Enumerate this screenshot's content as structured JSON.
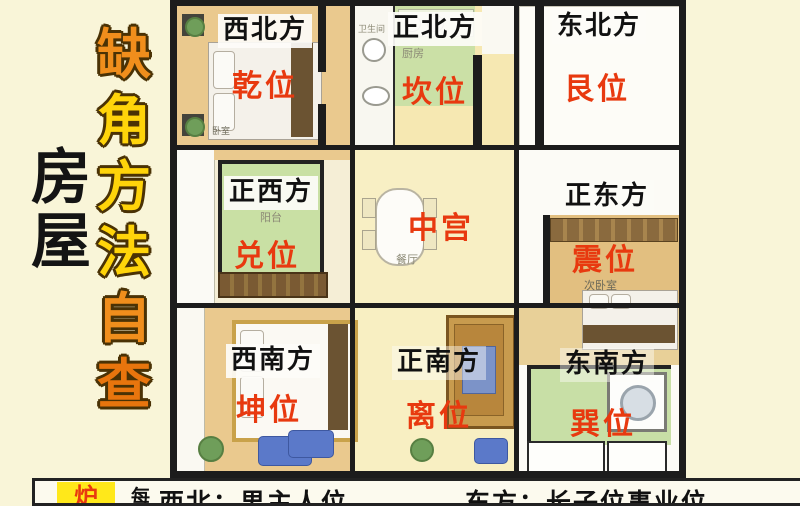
{
  "page": {
    "background": "#F9F5D8"
  },
  "title": {
    "chars": [
      {
        "ch": "缺",
        "tone": "orange"
      },
      {
        "ch": "角",
        "tone": "yellow"
      },
      {
        "ch": "方",
        "tone": "yellow"
      },
      {
        "ch": "法",
        "tone": "yellow"
      },
      {
        "ch": "自",
        "tone": "orange"
      },
      {
        "ch": "查",
        "tone": "deep"
      }
    ],
    "side_chars": [
      "房",
      "屋"
    ],
    "colors": {
      "orange": "#F08E1C",
      "yellow": "#FFD40A",
      "deep_orange": "#E8750D",
      "outline": "#4A3205",
      "side_text": "#141414"
    }
  },
  "floorplan": {
    "cells": [
      {
        "direction": "西北方",
        "position": "乾位",
        "room": "卧室"
      },
      {
        "direction": "正北方",
        "position": "坎位",
        "room": "厨房",
        "room2": "卫生间"
      },
      {
        "direction": "东北方",
        "position": "艮位",
        "room": ""
      },
      {
        "direction": "正西方",
        "position": "兑位",
        "room": "阳台"
      },
      {
        "direction": "",
        "position": "中宫",
        "room": "餐厅"
      },
      {
        "direction": "正东方",
        "position": "震位",
        "room": "次卧室"
      },
      {
        "direction": "西南方",
        "position": "坤位",
        "room": ""
      },
      {
        "direction": "正南方",
        "position": "离位",
        "room": ""
      },
      {
        "direction": "东南方",
        "position": "巽位",
        "room": ""
      }
    ],
    "colors": {
      "wall": "#1C1C1C",
      "direction_label": "#111111",
      "position_label": "#E8390F",
      "floor_tan": "#EAC98E",
      "floor_green": "#CBE0A6",
      "floor_pale_yellow": "#F8EFC4",
      "floor_white": "#FCFBF6"
    }
  },
  "bottom_bar": {
    "badge_text": "炉",
    "badge_bg": "#FFE81A",
    "badge_color": "#E8390F",
    "prefix": "每",
    "left_text": "西北：男主人位",
    "right_text": "东方：长子位事业位"
  }
}
